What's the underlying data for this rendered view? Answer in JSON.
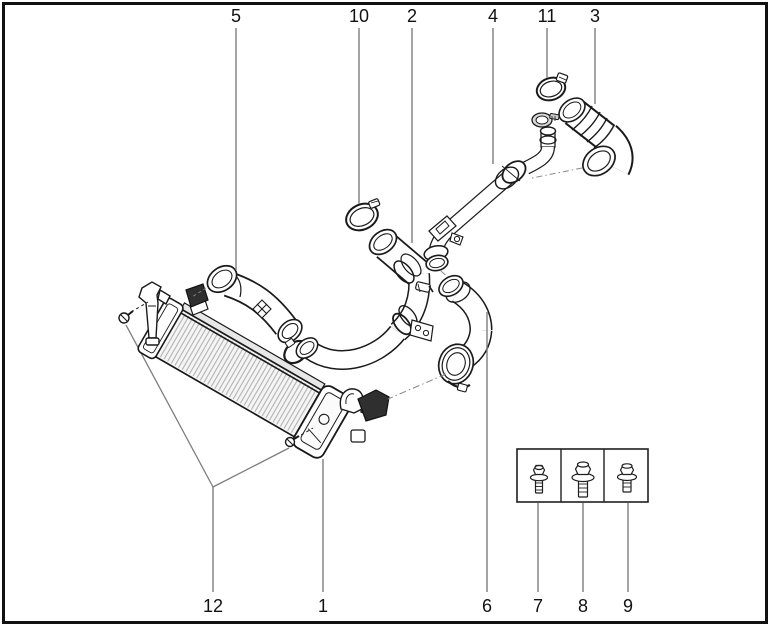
{
  "diagram": {
    "background": "#ffffff",
    "border_color": "#111111",
    "line_color": "#1a1a1a",
    "leader_color": "#7d7d7d",
    "text_color": "#111111",
    "callout_font_size": 18,
    "callouts_top": [
      {
        "label": "5",
        "x": 236,
        "text_y": 22,
        "line_y1": 28,
        "line_y2": 270
      },
      {
        "label": "10",
        "x": 359,
        "text_y": 22,
        "line_y1": 28,
        "line_y2": 204
      },
      {
        "label": "2",
        "x": 412,
        "text_y": 22,
        "line_y1": 28,
        "line_y2": 243
      },
      {
        "label": "4",
        "x": 493,
        "text_y": 22,
        "line_y1": 28,
        "line_y2": 164
      },
      {
        "label": "11",
        "x": 547,
        "text_y": 22,
        "line_y1": 28,
        "line_y2": 78
      },
      {
        "label": "3",
        "x": 595,
        "text_y": 22,
        "line_y1": 28,
        "line_y2": 104
      }
    ],
    "callouts_bottom": [
      {
        "label": "12",
        "x": 213,
        "text_y": 612,
        "line_y1": 487,
        "line_y2": 592
      },
      {
        "label": "1",
        "x": 323,
        "text_y": 612,
        "line_y1": 459,
        "line_y2": 592
      },
      {
        "label": "6",
        "x": 487,
        "text_y": 612,
        "line_y1": 312,
        "line_y2": 592
      },
      {
        "label": "7",
        "x": 538,
        "text_y": 612,
        "line_y1": 503,
        "line_y2": 592
      },
      {
        "label": "8",
        "x": 583,
        "text_y": 612,
        "line_y1": 503,
        "line_y2": 592
      },
      {
        "label": "9",
        "x": 628,
        "text_y": 612,
        "line_y1": 503,
        "line_y2": 592
      }
    ]
  }
}
